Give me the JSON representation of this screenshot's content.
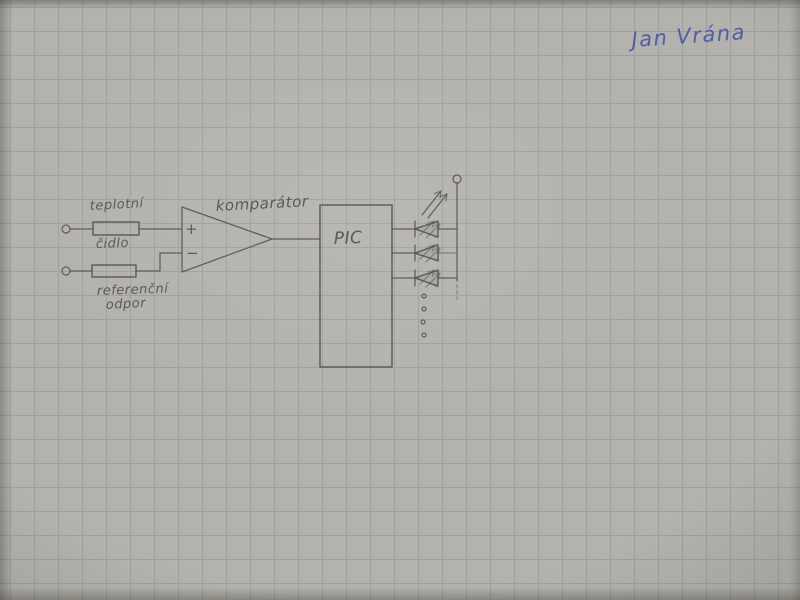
{
  "colors": {
    "paper": "#b3b2ad",
    "grid": "#8d9096",
    "pencil": "#55524b",
    "ink": "#4a55a8"
  },
  "signature": {
    "text": "Jan Vrána"
  },
  "circuit": {
    "sensor": {
      "label_top": "teplotní",
      "label_bottom": "čidlo"
    },
    "reference": {
      "label_top": "referenční",
      "label_bottom": "odpor"
    },
    "comparator": {
      "label": "komparátor",
      "plus": "+",
      "minus": "−"
    },
    "mcu": {
      "label": "PIC"
    },
    "leds": {
      "count": 3,
      "continuation_dots": 4
    }
  }
}
